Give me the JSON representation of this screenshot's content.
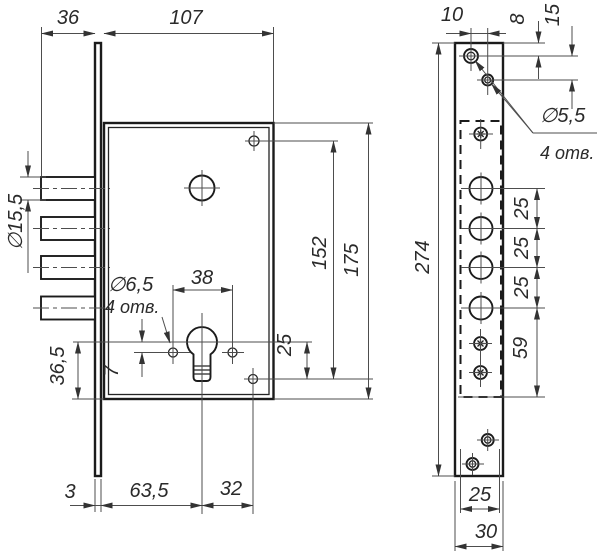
{
  "front_view": {
    "label_bolt_throw": "36",
    "label_body_width": "107",
    "label_bolt_diameter": "∅15,5",
    "label_hole_diameter": "∅6,5",
    "label_hole_count": "4 отв.",
    "label_hole_spacing": "38",
    "label_offset_7": "7",
    "label_cyl_to_bottom": "36,5",
    "label_offset_25": "25",
    "label_holes_span": "152",
    "label_body_height": "175",
    "label_faceplate_thickness": "3",
    "label_backset": "63,5",
    "label_offset_32": "32"
  },
  "side_view": {
    "label_hole_offset_10": "10",
    "label_edge_offset_8": "8",
    "label_hole_pitch_15": "15",
    "label_plate_height": "274",
    "label_hole_diameter": "∅5,5",
    "label_hole_count": "4 отв.",
    "label_pitch_25_1": "25",
    "label_pitch_25_2": "25",
    "label_pitch_25_3": "25",
    "label_offset_59": "59",
    "label_case_width_25": "25",
    "label_plate_width_30": "30"
  }
}
